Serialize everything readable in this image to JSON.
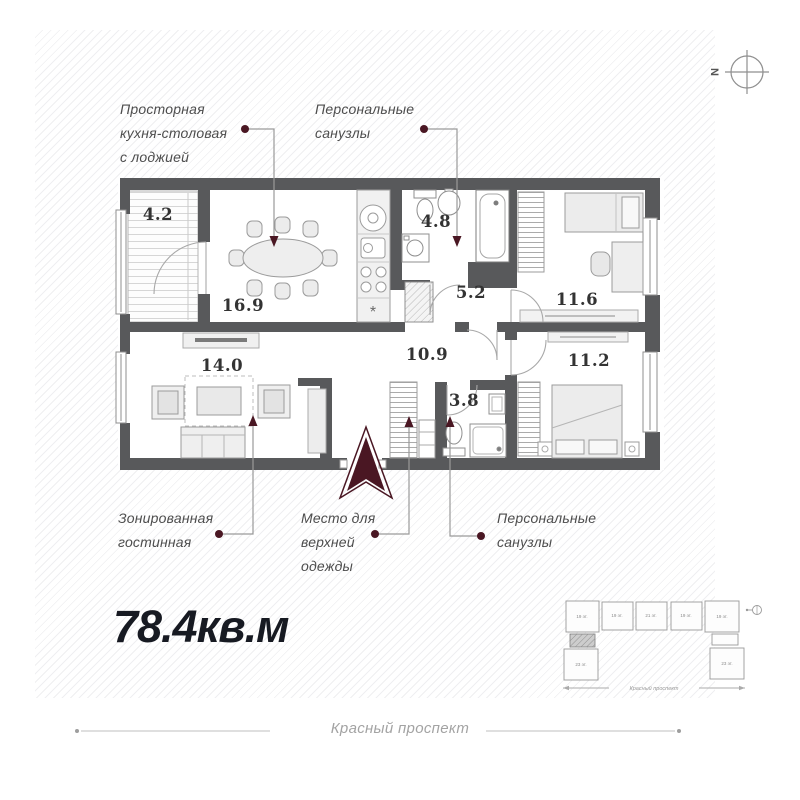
{
  "title": {
    "total_area": "78.4кв.м"
  },
  "street": {
    "label": "Красный проспект"
  },
  "compass": {
    "north": "N"
  },
  "plan": {
    "areas": {
      "loggia": "4.2",
      "kitchen_dining": "16.9",
      "bathroom_top": "4.8",
      "hall": "5.2",
      "bedroom_top": "11.6",
      "living_room": "14.0",
      "hallway": "10.9",
      "bedroom_bottom": "11.2",
      "bathroom_bottom": "3.8"
    }
  },
  "callouts": {
    "kitchen": {
      "lines": [
        "Просторная",
        "кухня-столовая",
        "с лоджией"
      ]
    },
    "bathrooms_top": {
      "lines": [
        "Персональные",
        "санузлы"
      ]
    },
    "living": {
      "lines": [
        "Зонированная",
        "гостинная"
      ]
    },
    "wardrobe": {
      "lines": [
        "Место для",
        "верхней",
        "одежды"
      ]
    },
    "bathrooms_bottom": {
      "lines": [
        "Персональные",
        "санузлы"
      ]
    }
  },
  "site_plan": {
    "sections": [
      "19 эт.",
      "19 эт.",
      "21 эт.",
      "19 эт.",
      "19 эт."
    ],
    "tower_left": "23 эт.",
    "tower_right": "23 эт.",
    "street": "Красный проспект"
  },
  "colors": {
    "accent": "#4a1723",
    "wall": "#58595b"
  }
}
